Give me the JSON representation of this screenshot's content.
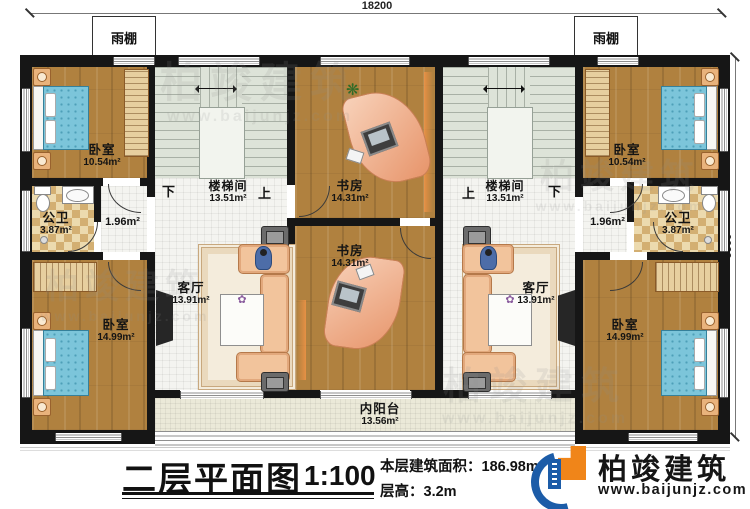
{
  "plan": {
    "dimensions": {
      "top": "18200",
      "right": "9900"
    },
    "canopy_left": "雨棚",
    "canopy_right": "雨棚",
    "rooms": {
      "bedroom_top_left": {
        "name": "卧室",
        "area": "10.54m²"
      },
      "bedroom_top_right": {
        "name": "卧室",
        "area": "10.54m²"
      },
      "bedroom_bottom_left": {
        "name": "卧室",
        "area": "14.99m²"
      },
      "bedroom_bottom_right": {
        "name": "卧室",
        "area": "14.99m²"
      },
      "bathroom_left": {
        "name": "公卫",
        "area": "3.87m²"
      },
      "bathroom_right": {
        "name": "公卫",
        "area": "3.87m²"
      },
      "corridor_left": {
        "area": "1.96m²"
      },
      "corridor_right": {
        "area": "1.96m²"
      },
      "stairwell_left": {
        "name": "楼梯间",
        "area": "13.51m²",
        "left_mark": "下",
        "right_mark": "上"
      },
      "stairwell_right": {
        "name": "楼梯间",
        "area": "13.51m²",
        "left_mark": "上",
        "right_mark": "下"
      },
      "study_upper": {
        "name": "书房",
        "area": "14.31m²"
      },
      "study_lower": {
        "name": "书房",
        "area": "14.31m²"
      },
      "living_left": {
        "name": "客厅",
        "area": "13.91m²"
      },
      "living_right": {
        "name": "客厅",
        "area": "13.91m²"
      },
      "balcony": {
        "name": "内阳台",
        "area": "13.56m²"
      }
    }
  },
  "title_block": {
    "title": "二层平面图",
    "scale": "1:100",
    "floor_area_label": "本层建筑面积：",
    "floor_area_value": "186.98m²",
    "floor_height_label": "层高：",
    "floor_height_value": "3.2m"
  },
  "brand": {
    "name": "柏竣建筑",
    "website": "www.baijunjz.com"
  },
  "watermark": {
    "name": "柏竣建筑",
    "website": "www.baijunjz.com"
  },
  "colors": {
    "wall": "#161616",
    "wood_floor": "#b0813f",
    "tile_floor": "#f4f4f0",
    "stair_floor": "#dde3d8",
    "checker_dark": "#d3af72",
    "checker_light": "#ecdaae",
    "balcony_floor": "#ebe9d8",
    "bed_blue": "#7cc5da",
    "sofa_salmon": "#f2c49c",
    "accent_orange": "#f08519",
    "brand_blue": "#1c5ca8"
  }
}
